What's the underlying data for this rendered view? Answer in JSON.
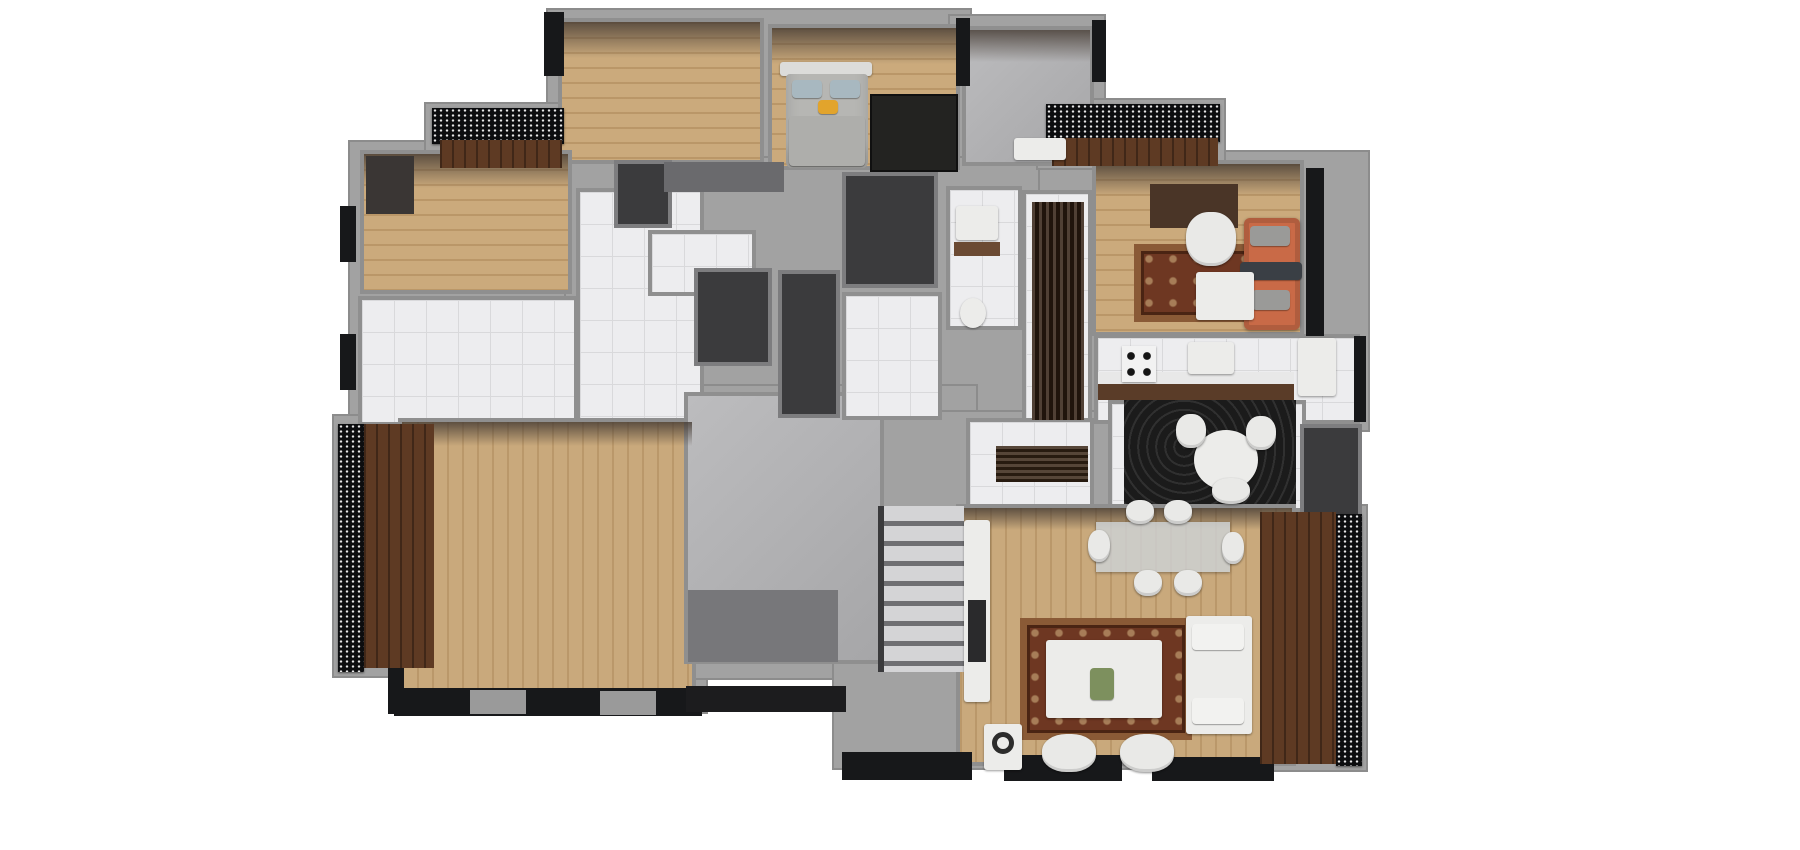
{
  "meta": {
    "canvas_width": 1800,
    "canvas_height": 850,
    "background": "#ffffff"
  },
  "palette": {
    "wall_gray": "#9e9e9e",
    "wall_border": "#8f8f8f",
    "wall_face_shade": "#55504b",
    "exterior_black": "#17181a",
    "floor_wood_light": "#cbaa7c",
    "floor_tile_white": "#ededef",
    "floor_concrete": "#b6b6b8",
    "balcony_walnut": "#5e3a23",
    "dark_shaft": "#3b3b3d",
    "rug_dark": "#232321",
    "rug_swirl_black": "#1b1b1b",
    "rug_ornate_brown": "#6e3722",
    "rug_ornate_tan": "#c9a87a",
    "sofa_orange": "#c96a47",
    "furniture_white": "#ececea",
    "bed_gray": "#b6b6b3",
    "accent_pillow_yellow": "#e2a42c"
  },
  "scene": {
    "elements": [
      {
        "name": "base-top-left-wing",
        "cls": "base",
        "x": 548,
        "y": 10,
        "w": 422,
        "h": 162
      },
      {
        "name": "base-top-right-wing",
        "cls": "base",
        "x": 950,
        "y": 16,
        "w": 154,
        "h": 152
      },
      {
        "name": "base-left-wing",
        "cls": "base",
        "x": 350,
        "y": 142,
        "w": 236,
        "h": 292
      },
      {
        "name": "base-center-block",
        "cls": "base",
        "x": 566,
        "y": 158,
        "w": 534,
        "h": 286
      },
      {
        "name": "base-right-wing",
        "cls": "base",
        "x": 1040,
        "y": 152,
        "w": 328,
        "h": 278
      },
      {
        "name": "base-bottom-left-wing",
        "cls": "base",
        "x": 390,
        "y": 410,
        "w": 316,
        "h": 302
      },
      {
        "name": "base-stair-block",
        "cls": "base",
        "x": 676,
        "y": 386,
        "w": 300,
        "h": 292
      },
      {
        "name": "base-bottom-right-wing",
        "cls": "base",
        "x": 834,
        "y": 412,
        "w": 470,
        "h": 356
      },
      {
        "name": "base-balcony-right",
        "cls": "base",
        "x": 1254,
        "y": 506,
        "w": 112,
        "h": 264
      },
      {
        "name": "base-balcony-left",
        "cls": "base",
        "x": 334,
        "y": 416,
        "w": 104,
        "h": 260
      },
      {
        "name": "base-balcony-top-left",
        "cls": "base",
        "x": 426,
        "y": 104,
        "w": 144,
        "h": 66
      },
      {
        "name": "base-balcony-top-right",
        "cls": "base",
        "x": 1038,
        "y": 100,
        "w": 186,
        "h": 68
      },
      {
        "name": "room-bedroom-nw",
        "cls": "room wood-h",
        "x": 558,
        "y": 18,
        "w": 206,
        "h": 146
      },
      {
        "name": "room-bedroom-n",
        "cls": "room wood-h",
        "x": 768,
        "y": 24,
        "w": 192,
        "h": 146
      },
      {
        "name": "room-utility-ne",
        "cls": "room concrete",
        "x": 962,
        "y": 26,
        "w": 132,
        "h": 140
      },
      {
        "name": "room-bedroom-w",
        "cls": "room wood-h",
        "x": 360,
        "y": 150,
        "w": 212,
        "h": 144
      },
      {
        "name": "room-kitchen-w",
        "cls": "room tile",
        "x": 358,
        "y": 296,
        "w": 220,
        "h": 130
      },
      {
        "name": "room-hall-w",
        "cls": "room tile",
        "x": 576,
        "y": 188,
        "w": 128,
        "h": 242
      },
      {
        "name": "room-hall-w-patch",
        "cls": "room tile",
        "x": 648,
        "y": 230,
        "w": 108,
        "h": 66
      },
      {
        "name": "room-living-sw",
        "cls": "room wood-v",
        "x": 398,
        "y": 418,
        "w": 298,
        "h": 288
      },
      {
        "name": "room-stair-hall",
        "cls": "room concrete",
        "x": 684,
        "y": 392,
        "w": 200,
        "h": 272
      },
      {
        "name": "room-bath-c",
        "cls": "room tile",
        "x": 946,
        "y": 186,
        "w": 76,
        "h": 144
      },
      {
        "name": "room-hall-r",
        "cls": "room tile",
        "x": 1022,
        "y": 190,
        "w": 70,
        "h": 242
      },
      {
        "name": "room-closet-c",
        "cls": "room darkroom",
        "x": 842,
        "y": 172,
        "w": 96,
        "h": 116
      },
      {
        "name": "room-hall-c-patch",
        "cls": "room tile",
        "x": 842,
        "y": 292,
        "w": 100,
        "h": 128
      },
      {
        "name": "room-living-r",
        "cls": "room wood-h",
        "x": 1092,
        "y": 160,
        "w": 212,
        "h": 176
      },
      {
        "name": "room-kitchen-r",
        "cls": "room tile",
        "x": 1094,
        "y": 334,
        "w": 266,
        "h": 90
      },
      {
        "name": "room-dining-r",
        "cls": "room tile",
        "x": 1108,
        "y": 400,
        "w": 198,
        "h": 112
      },
      {
        "name": "room-bath-r-dark",
        "cls": "room darkroom",
        "x": 1300,
        "y": 424,
        "w": 62,
        "h": 94
      },
      {
        "name": "room-elevator-a",
        "cls": "room darkroom",
        "x": 694,
        "y": 268,
        "w": 78,
        "h": 98
      },
      {
        "name": "room-elevator-b",
        "cls": "room darkroom",
        "x": 778,
        "y": 270,
        "w": 62,
        "h": 148
      },
      {
        "name": "room-foyer-br",
        "cls": "room tile",
        "x": 966,
        "y": 418,
        "w": 128,
        "h": 92
      },
      {
        "name": "room-living-br",
        "cls": "room wood-v",
        "x": 956,
        "y": 504,
        "w": 340,
        "h": 262
      },
      {
        "name": "room-closet-nw",
        "cls": "room darkroom",
        "x": 614,
        "y": 160,
        "w": 58,
        "h": 68
      },
      {
        "name": "wall-shade-nw",
        "cls": "shade",
        "x": 562,
        "y": 22,
        "w": 198,
        "h": 36
      },
      {
        "name": "wall-shade-n",
        "cls": "shade",
        "x": 772,
        "y": 28,
        "w": 184,
        "h": 36
      },
      {
        "name": "wall-shade-ne",
        "cls": "shade",
        "x": 966,
        "y": 30,
        "w": 124,
        "h": 32
      },
      {
        "name": "wall-shade-w",
        "cls": "shade",
        "x": 364,
        "y": 154,
        "w": 204,
        "h": 34
      },
      {
        "name": "wall-shade-r",
        "cls": "shade",
        "x": 1096,
        "y": 164,
        "w": 204,
        "h": 32
      },
      {
        "name": "wall-shade-sw",
        "cls": "shade",
        "x": 402,
        "y": 422,
        "w": 290,
        "h": 24
      },
      {
        "name": "wall-shade-br",
        "cls": "shade",
        "x": 960,
        "y": 508,
        "w": 332,
        "h": 22
      },
      {
        "name": "exterior-corner-top-left",
        "cls": "accent",
        "x": 544,
        "y": 12,
        "w": 20,
        "h": 64
      },
      {
        "name": "exterior-divider-top",
        "cls": "accent",
        "x": 956,
        "y": 18,
        "w": 14,
        "h": 68
      },
      {
        "name": "exterior-corner-top-right",
        "cls": "accent",
        "x": 1092,
        "y": 20,
        "w": 14,
        "h": 62
      },
      {
        "name": "exterior-windows-right",
        "cls": "accent",
        "x": 1306,
        "y": 168,
        "w": 18,
        "h": 168
      },
      {
        "name": "exterior-left-1",
        "cls": "accent",
        "x": 340,
        "y": 206,
        "w": 16,
        "h": 56
      },
      {
        "name": "exterior-left-2",
        "cls": "accent",
        "x": 340,
        "y": 334,
        "w": 16,
        "h": 56
      },
      {
        "name": "exterior-bottom-sw",
        "cls": "accent",
        "x": 394,
        "y": 688,
        "w": 308,
        "h": 28
      },
      {
        "name": "window-gap-1",
        "cls": "accent",
        "x": 470,
        "y": 690,
        "w": 56,
        "h": 24,
        "color": "#9a9a9a"
      },
      {
        "name": "window-gap-2",
        "cls": "accent",
        "x": 600,
        "y": 691,
        "w": 56,
        "h": 24,
        "color": "#9a9a9a"
      },
      {
        "name": "exterior-bottom-br-1",
        "cls": "accent",
        "x": 842,
        "y": 752,
        "w": 130,
        "h": 28
      },
      {
        "name": "exterior-bottom-br-2",
        "cls": "accent",
        "x": 1004,
        "y": 755,
        "w": 118,
        "h": 26
      },
      {
        "name": "exterior-bottom-br-3",
        "cls": "accent",
        "x": 1152,
        "y": 757,
        "w": 122,
        "h": 24
      },
      {
        "name": "exterior-right-kitchen",
        "cls": "accent",
        "x": 1354,
        "y": 336,
        "w": 12,
        "h": 86
      },
      {
        "name": "stair-lower-shadow",
        "cls": "accent",
        "x": 688,
        "y": 590,
        "w": 150,
        "h": 72,
        "color": "#77777a"
      },
      {
        "name": "stair-base-dark",
        "cls": "accent",
        "x": 686,
        "y": 686,
        "w": 160,
        "h": 26,
        "color": "#1c1c1e"
      },
      {
        "name": "exterior-corner-bl",
        "cls": "accent",
        "x": 388,
        "y": 662,
        "w": 16,
        "h": 52
      },
      {
        "name": "core-top-band",
        "cls": "accent",
        "x": 664,
        "y": 162,
        "w": 120,
        "h": 30,
        "color": "#6a6a6d"
      },
      {
        "name": "balcony-railing-top-left",
        "cls": "railing",
        "x": 432,
        "y": 108,
        "w": 132,
        "h": 36
      },
      {
        "name": "balcony-railing-top-right",
        "cls": "railing",
        "x": 1046,
        "y": 104,
        "w": 174,
        "h": 38
      },
      {
        "name": "balcony-railing-left",
        "cls": "railing",
        "x": 338,
        "y": 424,
        "w": 26,
        "h": 248
      },
      {
        "name": "balcony-railing-right",
        "cls": "railing",
        "x": 1336,
        "y": 514,
        "w": 26,
        "h": 252
      },
      {
        "name": "balcony-floor-top-left",
        "cls": "walnut",
        "x": 440,
        "y": 140,
        "w": 122,
        "h": 28
      },
      {
        "name": "balcony-floor-top-right",
        "cls": "walnut",
        "x": 1052,
        "y": 138,
        "w": 166,
        "h": 28
      },
      {
        "name": "balcony-floor-left",
        "cls": "walnut",
        "x": 364,
        "y": 424,
        "w": 70,
        "h": 244
      },
      {
        "name": "balcony-floor-right",
        "cls": "walnut",
        "x": 1260,
        "y": 512,
        "w": 76,
        "h": 252
      },
      {
        "name": "bed-headboard",
        "cls": "furn",
        "x": 780,
        "y": 62,
        "w": 92,
        "h": 14,
        "color": "#dcdcda"
      },
      {
        "name": "bed-mattress",
        "cls": "bedm",
        "x": 786,
        "y": 74,
        "w": 82,
        "h": 94
      },
      {
        "name": "bed-pillow-1",
        "cls": "pillow",
        "x": 792,
        "y": 80,
        "w": 30,
        "h": 18,
        "color": "#a8b8c0"
      },
      {
        "name": "bed-pillow-2",
        "cls": "pillow",
        "x": 830,
        "y": 80,
        "w": 30,
        "h": 18,
        "color": "#a8b8c0"
      },
      {
        "name": "bed-accent-pillow",
        "cls": "pillow",
        "x": 818,
        "y": 100,
        "w": 20,
        "h": 14,
        "color": "#e2a42c"
      },
      {
        "name": "bed-blanket",
        "cls": "pillow",
        "x": 789,
        "y": 116,
        "w": 76,
        "h": 50,
        "color": "#aeaeab"
      },
      {
        "name": "rug-bedroom-n",
        "cls": "darkrug",
        "x": 872,
        "y": 96,
        "w": 84,
        "h": 74
      },
      {
        "name": "wardrobe-w",
        "cls": "accent",
        "x": 366,
        "y": 156,
        "w": 48,
        "h": 58,
        "color": "#3a3634"
      },
      {
        "name": "bench-ne",
        "cls": "furn",
        "x": 1014,
        "y": 138,
        "w": 52,
        "h": 22
      },
      {
        "name": "sink-bath-c",
        "cls": "furn",
        "x": 956,
        "y": 206,
        "w": 42,
        "h": 34
      },
      {
        "name": "counter-bath-c",
        "cls": "accent",
        "x": 954,
        "y": 242,
        "w": 46,
        "h": 14,
        "color": "#6b4a33"
      },
      {
        "name": "toilet-bath-c",
        "cls": "furn circle",
        "x": 960,
        "y": 298,
        "w": 26,
        "h": 30
      },
      {
        "name": "runner-hall-r",
        "cls": "runner",
        "x": 1032,
        "y": 202,
        "w": 52,
        "h": 218
      },
      {
        "name": "tv-unit-r",
        "cls": "accent",
        "x": 1150,
        "y": 184,
        "w": 88,
        "h": 44,
        "color": "#4a3527"
      },
      {
        "name": "rug-living-r",
        "cls": "ornate",
        "x": 1134,
        "y": 244,
        "w": 138,
        "h": 78
      },
      {
        "name": "armchair-r",
        "cls": "chair",
        "x": 1186,
        "y": 212,
        "w": 50,
        "h": 54
      },
      {
        "name": "sofa-orange",
        "cls": "sofa-orange",
        "x": 1244,
        "y": 218,
        "w": 56,
        "h": 112
      },
      {
        "name": "sofa-orange-pillow-1",
        "cls": "pillow",
        "x": 1250,
        "y": 226,
        "w": 40,
        "h": 20,
        "color": "#9a9a98"
      },
      {
        "name": "sofa-orange-pillow-2",
        "cls": "pillow",
        "x": 1252,
        "y": 290,
        "w": 38,
        "h": 20,
        "color": "#9a9a98"
      },
      {
        "name": "sofa-orange-throw",
        "cls": "pillow",
        "x": 1240,
        "y": 262,
        "w": 62,
        "h": 18,
        "color": "#3a3f45"
      },
      {
        "name": "coffee-table-r",
        "cls": "furn",
        "x": 1196,
        "y": 272,
        "w": 58,
        "h": 48
      },
      {
        "name": "kitchen-r-countertop",
        "cls": "accent",
        "x": 1098,
        "y": 372,
        "w": 196,
        "h": 12,
        "color": "#e8e8e8"
      },
      {
        "name": "kitchen-r-counterbase",
        "cls": "accent",
        "x": 1098,
        "y": 384,
        "w": 196,
        "h": 16,
        "color": "#5a3c28"
      },
      {
        "name": "stove-r",
        "cls": "stove",
        "x": 1122,
        "y": 346,
        "w": 34,
        "h": 36
      },
      {
        "name": "sink-kitchen-r",
        "cls": "furn",
        "x": 1188,
        "y": 342,
        "w": 46,
        "h": 32
      },
      {
        "name": "fridge-r",
        "cls": "furn",
        "x": 1298,
        "y": 338,
        "w": 38,
        "h": 58
      },
      {
        "name": "rug-swirl-dining",
        "cls": "swirl",
        "x": 1124,
        "y": 400,
        "w": 172,
        "h": 104
      },
      {
        "name": "table-round-dining",
        "cls": "furn circle",
        "x": 1194,
        "y": 430,
        "w": 64,
        "h": 60
      },
      {
        "name": "chair-dining-n1",
        "cls": "chair",
        "x": 1176,
        "y": 414,
        "w": 30,
        "h": 34
      },
      {
        "name": "chair-dining-n2",
        "cls": "chair",
        "x": 1246,
        "y": 416,
        "w": 30,
        "h": 34
      },
      {
        "name": "chair-dining-n3",
        "cls": "chair",
        "x": 1212,
        "y": 478,
        "w": 38,
        "h": 26
      },
      {
        "name": "doormat-foyer-br",
        "cls": "mat",
        "x": 996,
        "y": 446,
        "w": 92,
        "h": 36
      },
      {
        "name": "staircase-steps",
        "cls": "steps",
        "x": 878,
        "y": 506,
        "w": 86,
        "h": 166
      },
      {
        "name": "dining-table-br",
        "cls": "glass",
        "x": 1096,
        "y": 522,
        "w": 134,
        "h": 50
      },
      {
        "name": "dchair-br-1",
        "cls": "chair",
        "x": 1126,
        "y": 500,
        "w": 28,
        "h": 24
      },
      {
        "name": "dchair-br-2",
        "cls": "chair",
        "x": 1164,
        "y": 500,
        "w": 28,
        "h": 24
      },
      {
        "name": "dchair-br-3",
        "cls": "chair",
        "x": 1134,
        "y": 570,
        "w": 28,
        "h": 26
      },
      {
        "name": "dchair-br-4",
        "cls": "chair",
        "x": 1174,
        "y": 570,
        "w": 28,
        "h": 26
      },
      {
        "name": "dchair-br-5",
        "cls": "chair",
        "x": 1088,
        "y": 530,
        "w": 22,
        "h": 32
      },
      {
        "name": "dchair-br-6",
        "cls": "chair",
        "x": 1222,
        "y": 532,
        "w": 22,
        "h": 32
      },
      {
        "name": "tv-console-br",
        "cls": "furn",
        "x": 964,
        "y": 520,
        "w": 26,
        "h": 182
      },
      {
        "name": "tv-media-br",
        "cls": "accent",
        "x": 968,
        "y": 600,
        "w": 18,
        "h": 62,
        "color": "#2a2a2c"
      },
      {
        "name": "rug-living-br",
        "cls": "ornate",
        "x": 1020,
        "y": 618,
        "w": 172,
        "h": 122
      },
      {
        "name": "coffee-table-br",
        "cls": "furn",
        "x": 1046,
        "y": 640,
        "w": 116,
        "h": 78
      },
      {
        "name": "decor-plant-br",
        "cls": "pillow",
        "x": 1090,
        "y": 668,
        "w": 24,
        "h": 32,
        "color": "#7d905e"
      },
      {
        "name": "sofa-white-br",
        "cls": "furn",
        "x": 1186,
        "y": 616,
        "w": 66,
        "h": 118
      },
      {
        "name": "sofa-br-pillow-1",
        "cls": "pillow",
        "x": 1192,
        "y": 624,
        "w": 52,
        "h": 26,
        "color": "#f2f2f0"
      },
      {
        "name": "sofa-br-pillow-2",
        "cls": "pillow",
        "x": 1192,
        "y": 698,
        "w": 52,
        "h": 26,
        "color": "#f2f2f0"
      },
      {
        "name": "armchair-br-1",
        "cls": "chair",
        "x": 1042,
        "y": 734,
        "w": 54,
        "h": 38
      },
      {
        "name": "armchair-br-2",
        "cls": "chair",
        "x": 1120,
        "y": 734,
        "w": 54,
        "h": 38
      },
      {
        "name": "side-table-br",
        "cls": "furn",
        "x": 984,
        "y": 724,
        "w": 38,
        "h": 46
      },
      {
        "name": "headphones-stand",
        "cls": "ring",
        "x": 992,
        "y": 732,
        "w": 22,
        "h": 22
      }
    ]
  }
}
